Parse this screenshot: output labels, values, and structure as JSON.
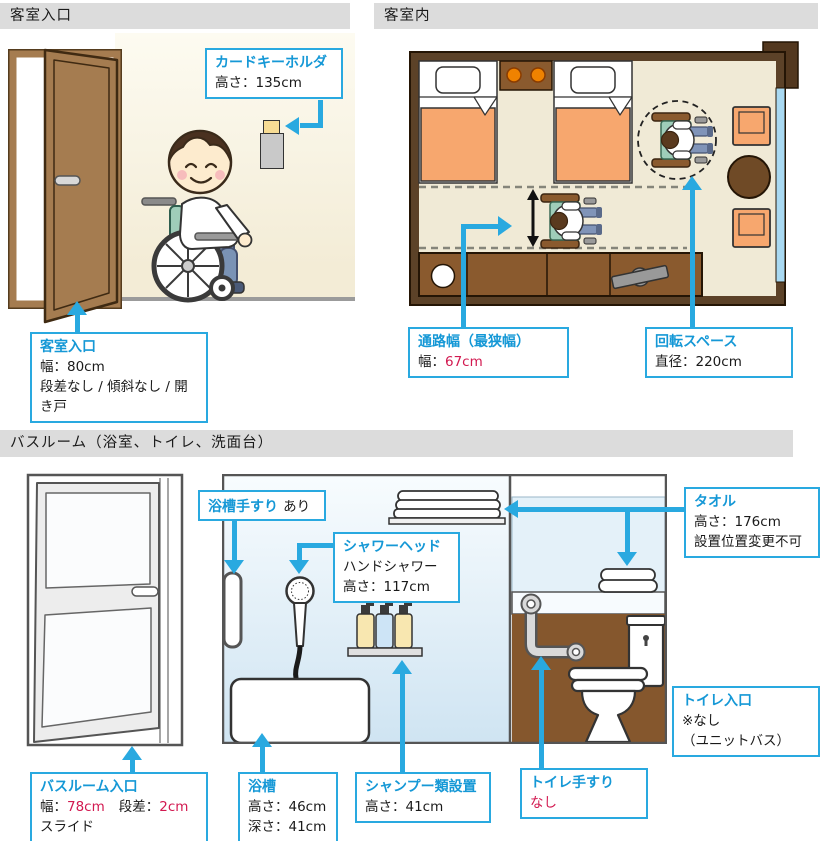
{
  "colors": {
    "accent": "#29a9e0",
    "title_blue": "#1598d6",
    "value_red": "#d21950",
    "header_bg": "#dcdcdc",
    "plan_wall": "#5c4228",
    "plan_floor": "#f0ead6",
    "bed_orange": "#f7a76e",
    "bathroom_wall_brown": "#85572d"
  },
  "headers": {
    "entrance": "客室入口",
    "room": "客室内",
    "bathroom": "バスルーム（浴室、トイレ、洗面台）"
  },
  "entrance": {
    "card_key": {
      "title": "カードキーホルダ",
      "height": "高さ：135cm"
    },
    "door": {
      "title": "客室入口",
      "width": "幅：80cm",
      "detail": "段差なし / 傾斜なし / 開き戸"
    }
  },
  "room": {
    "passage": {
      "title": "通路幅（最狭幅）",
      "label": "幅：",
      "value": "67cm"
    },
    "turning": {
      "title": "回転スペース",
      "diameter": "直径：220cm"
    }
  },
  "bathroom": {
    "tub_grab": {
      "title": "浴槽手すり",
      "status": "あり"
    },
    "shower": {
      "title": "シャワーヘッド",
      "type": "ハンドシャワー",
      "height": "高さ：117cm"
    },
    "towel": {
      "title": "タオル",
      "height": "高さ：176cm",
      "note": "設置位置変更不可"
    },
    "entrance": {
      "title": "バスルーム入口",
      "width_label": "幅：",
      "width_value": "78cm",
      "step_label": "段差：",
      "step_value": "2cm",
      "type": "スライド"
    },
    "tub": {
      "title": "浴槽",
      "height": "高さ：46cm",
      "depth": "深さ：41cm"
    },
    "shampoo": {
      "title": "シャンプー類設置",
      "height": "高さ：41cm"
    },
    "toilet_grab": {
      "title": "トイレ手すり",
      "status": "なし"
    },
    "toilet_entrance": {
      "title": "トイレ入口",
      "status": "※なし",
      "note": "（ユニットバス）"
    }
  }
}
